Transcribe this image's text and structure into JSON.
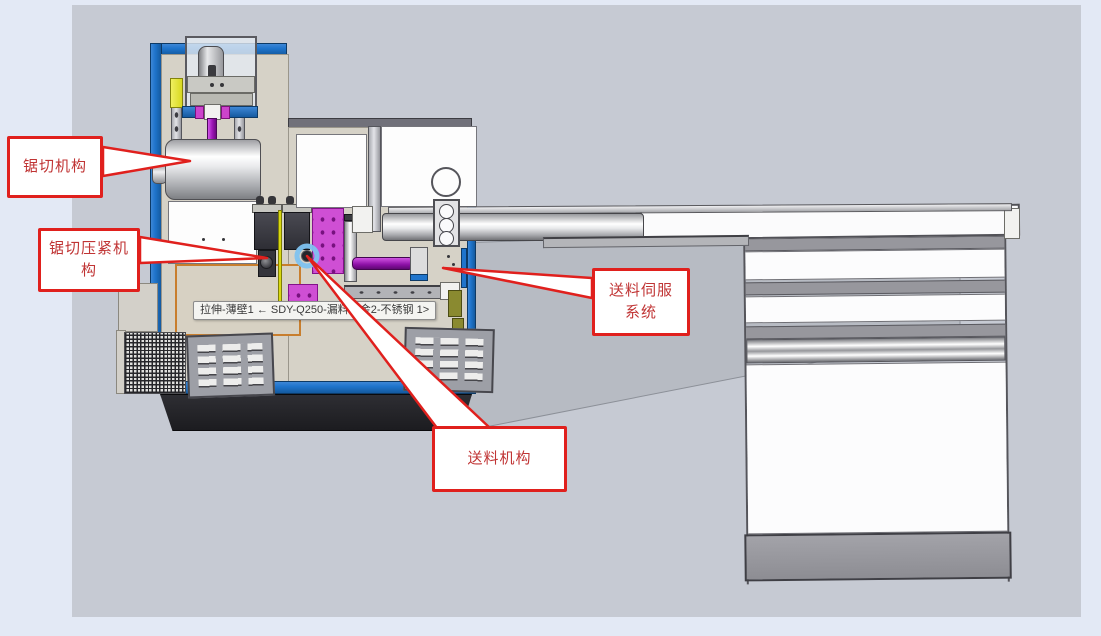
{
  "window": {
    "background": "#e3e9f5",
    "viewport_background": "#c6cad3"
  },
  "callouts": [
    {
      "id": "saw-mechanism",
      "label": "锯切机构"
    },
    {
      "id": "saw-clamp-mechanism",
      "label": "锯切压紧机构"
    },
    {
      "id": "feed-servo-system",
      "label": "送料伺服系统"
    },
    {
      "id": "feed-mechanism",
      "label": "送料机构"
    }
  ],
  "tooltip": {
    "text": "拉伸-薄壁1 ← SDY-Q250-漏料板金2-不锈钢 1>"
  },
  "colors": {
    "callout_border": "#e0201d",
    "callout_text": "#c03434",
    "machine_frame_blue": "#1f74cc",
    "machine_body_beige": "#d6d2c7",
    "highlight_magenta": "#cf4fd4",
    "shaft_purple": "#9b15b5",
    "selection_glow_blue": "#7ec2f0",
    "selected_edge_orange": "#c87e2e",
    "base_black": "#242428",
    "stand_gray": "#97979d"
  }
}
